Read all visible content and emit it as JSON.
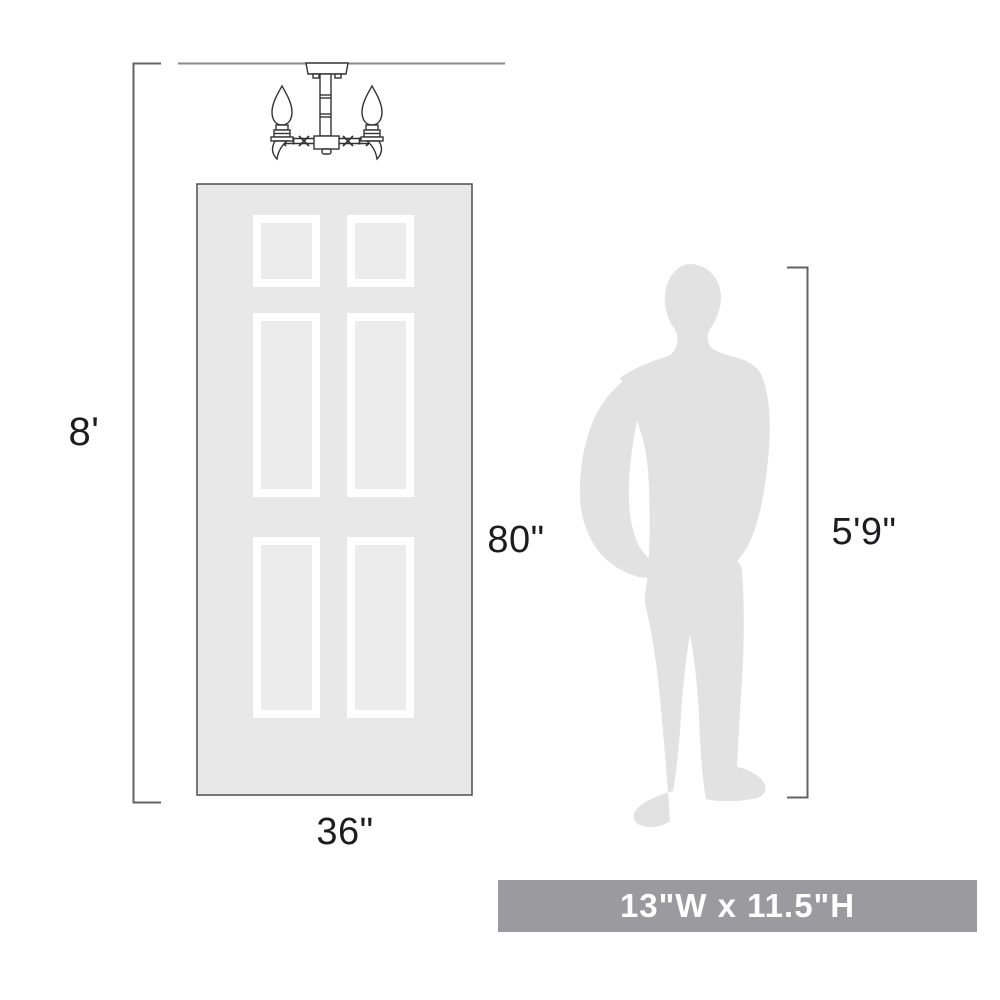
{
  "diagram": {
    "title": "light fixture size comparison diagram",
    "labels": {
      "ceiling_height": "8'",
      "door_height": "80\"",
      "door_width": "36\"",
      "person_height": "5'9\""
    },
    "size_banner": {
      "text": "13\"W x 11.5\"H",
      "bg_color": "#9b9a9e",
      "text_color": "#ffffff"
    },
    "objects": {
      "fixture": "two-light-semi-flush-ceiling-fixture-drawing",
      "door": "six-panel-door",
      "person": "standing-man-silhouette"
    },
    "colors": {
      "door_fill": "#e8e8e8",
      "door_border": "#4d4d4d",
      "panel_frame": "#ffffff",
      "panel_inner": "#ececec",
      "silhouette": "#e2e2e2",
      "dimension_line": "#636363",
      "ceiling_line": "#8a8a8a",
      "fixture_stroke": "#333333",
      "label_text": "#1d1d1f"
    }
  }
}
